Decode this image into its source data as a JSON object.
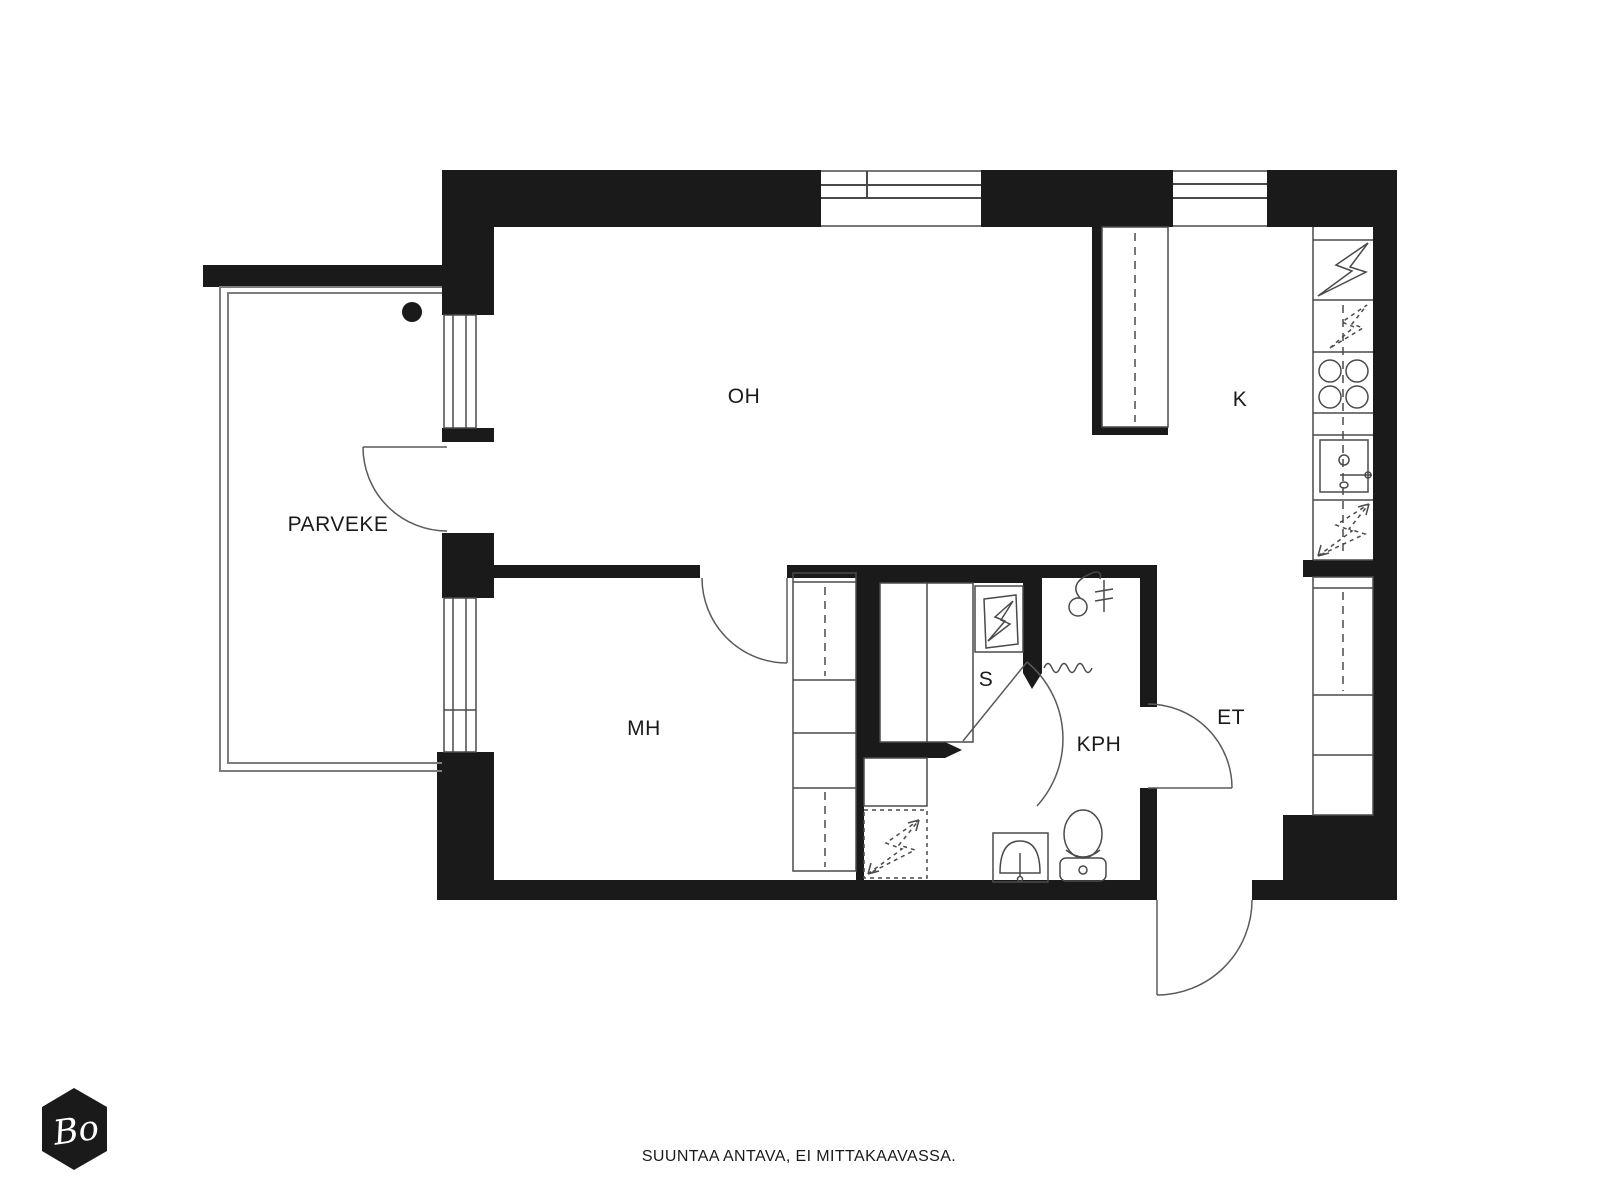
{
  "plan": {
    "rooms": {
      "living_room": "OH",
      "kitchen": "K",
      "balcony": "PARVEKE",
      "bedroom": "MH",
      "sauna": "S",
      "bathroom": "KPH",
      "hallway": "ET"
    },
    "footer": {
      "disclaimer": "SUUNTAA ANTAVA, EI MITTAKAAVASSA."
    },
    "logo": {
      "text": "Bo"
    },
    "symbols": {
      "solid_lightning": "electric-appliance-icon",
      "dashed_lightning": "appliance-reservation-icon",
      "four_circles": "stove-hob-icon",
      "wavy_line": "towel-radiator-icon",
      "circle_hose": "shower-icon"
    },
    "colors": {
      "wall": "#1a1a1a",
      "line": "#4a4a4a",
      "ink": "#1a1a1a",
      "background": "#ffffff"
    }
  }
}
